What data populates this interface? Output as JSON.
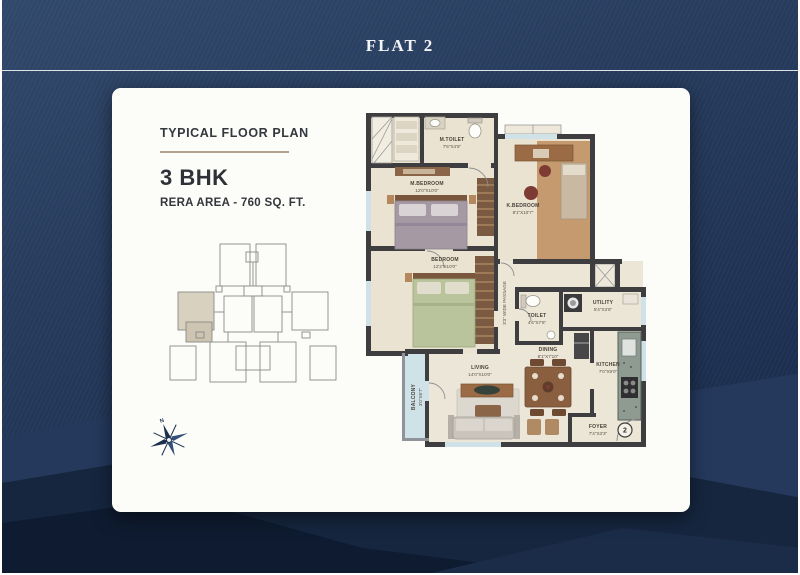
{
  "page": {
    "title": "FLAT 2"
  },
  "panel": {
    "heading": "TYPICAL FLOOR PLAN",
    "unit_type": "3 BHK",
    "rera_area": "RERA AREA - 760 SQ. FT."
  },
  "plan": {
    "passage_label": "3'3\" WIDE PASSAGE",
    "unit_number": "2",
    "compass_north": "N",
    "rooms": [
      {
        "name": "M.TOILET",
        "dims": "7'6\"X4'6\""
      },
      {
        "name": "M.BEDROOM",
        "dims": "12'0\"X10'0\""
      },
      {
        "name": "K.BEDROOM",
        "dims": "8'1\"X10'7\""
      },
      {
        "name": "BEDROOM",
        "dims": "12'2\"X10'0\""
      },
      {
        "name": "TOILET",
        "dims": "4'6\"X7'6\""
      },
      {
        "name": "UTILITY",
        "dims": "5'4\"X3'6\""
      },
      {
        "name": "DINING",
        "dims": "8'1\"X7'10\""
      },
      {
        "name": "KITCHEN",
        "dims": "7'0\"X9'0\""
      },
      {
        "name": "LIVING",
        "dims": "14'0\"X10'0\""
      },
      {
        "name": "BALCONY",
        "dims": "3'0\"X6'7\""
      },
      {
        "name": "FOYER",
        "dims": "7'4\"X3'3\""
      }
    ]
  },
  "colors": {
    "background_navy": "#273c5e",
    "card_white": "#fcfcf9",
    "heading_text": "#33383e",
    "underline_tan": "#b2a18c",
    "wall_dark": "#3e3d3f",
    "floor_beige": "#eae3d2",
    "balcony_blue": "#cfe2e7",
    "wood_brown": "#c49a6e",
    "compass_navy": "#1c2f4e"
  }
}
